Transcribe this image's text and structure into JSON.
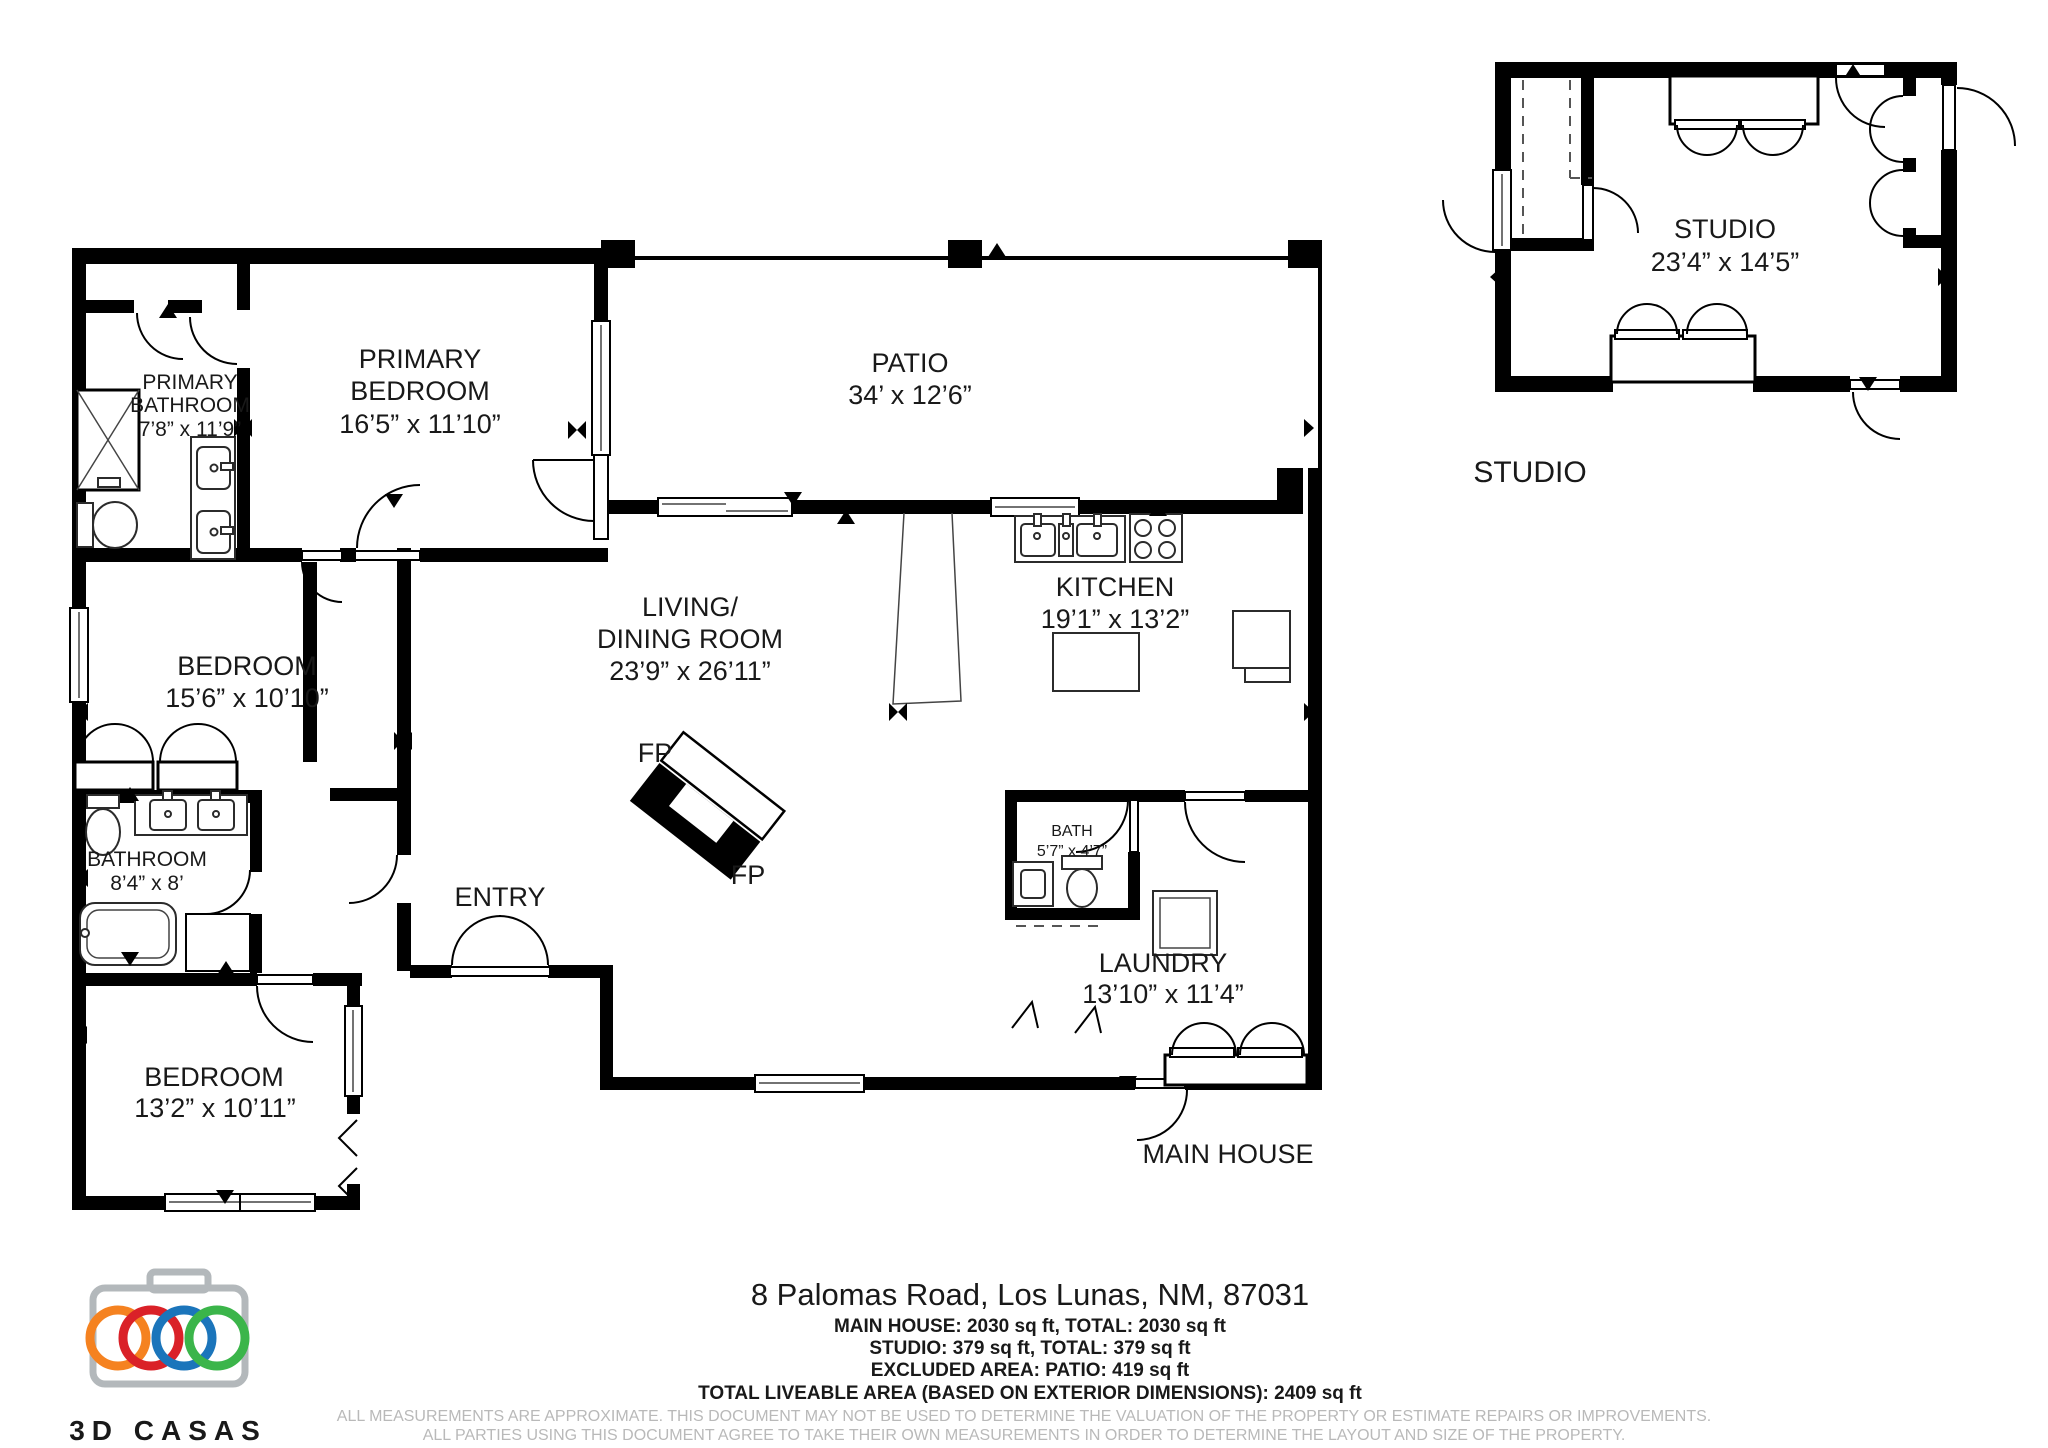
{
  "document": {
    "address": "8 Palomas Road, Los Lunas, NM, 87031",
    "summary": [
      "MAIN HOUSE: 2030 sq ft, TOTAL: 2030 sq ft",
      "STUDIO: 379 sq ft, TOTAL: 379 sq ft",
      "EXCLUDED AREA: PATIO: 419 sq ft",
      "TOTAL LIVEABLE AREA (BASED ON EXTERIOR DIMENSIONS): 2409 sq ft"
    ],
    "disclaimers": [
      "ALL MEASUREMENTS ARE APPROXIMATE. THIS DOCUMENT MAY NOT BE USED TO DETERMINE THE VALUATION OF THE PROPERTY OR ESTIMATE REPAIRS OR IMPROVEMENTS.",
      "ALL PARTIES USING THIS DOCUMENT AGREE TO TAKE THEIR OWN MEASUREMENTS IN ORDER TO DETERMINE THE LAYOUT AND SIZE OF THE PROPERTY."
    ]
  },
  "main_house": {
    "caption": "MAIN HOUSE",
    "fireplace_label": "FP",
    "rooms": {
      "primary_bathroom": {
        "line1": "PRIMARY",
        "line2": "BATHROOM",
        "dims": "7’8” x 11’9”"
      },
      "primary_bedroom": {
        "line1": "PRIMARY",
        "line2": "BEDROOM",
        "dims": "16’5” x 11’10”"
      },
      "patio": {
        "name": "PATIO",
        "dims": "34’ x 12’6”"
      },
      "living_dining": {
        "line1": "LIVING/",
        "line2": "DINING ROOM",
        "dims": "23’9” x 26’11”"
      },
      "kitchen": {
        "name": "KITCHEN",
        "dims": "19’1” x 13’2”"
      },
      "bedroom_west": {
        "name": "BEDROOM",
        "dims": "15’6” x 10’10”"
      },
      "bathroom": {
        "name": "BATHROOM",
        "dims": "8’4” x 8’"
      },
      "entry": {
        "name": "ENTRY"
      },
      "bath": {
        "name": "BATH",
        "dims": "5’7” x 4’7”"
      },
      "laundry": {
        "name": "LAUNDRY",
        "dims": "13’10” x 11’4”"
      },
      "bedroom_south": {
        "name": "BEDROOM",
        "dims": "13’2” x 10’11”"
      }
    }
  },
  "studio": {
    "caption": "STUDIO",
    "room": {
      "name": "STUDIO",
      "dims": "23’4” x 14’5”"
    }
  },
  "logo": {
    "brand": "3D CASAS",
    "ring_colors": {
      "orange": "#F58220",
      "red": "#DA2128",
      "blue": "#1B75BB",
      "green": "#3BB54A"
    },
    "camera_gray": "#b3b8bb",
    "text_gray": "#a2a8ab"
  }
}
